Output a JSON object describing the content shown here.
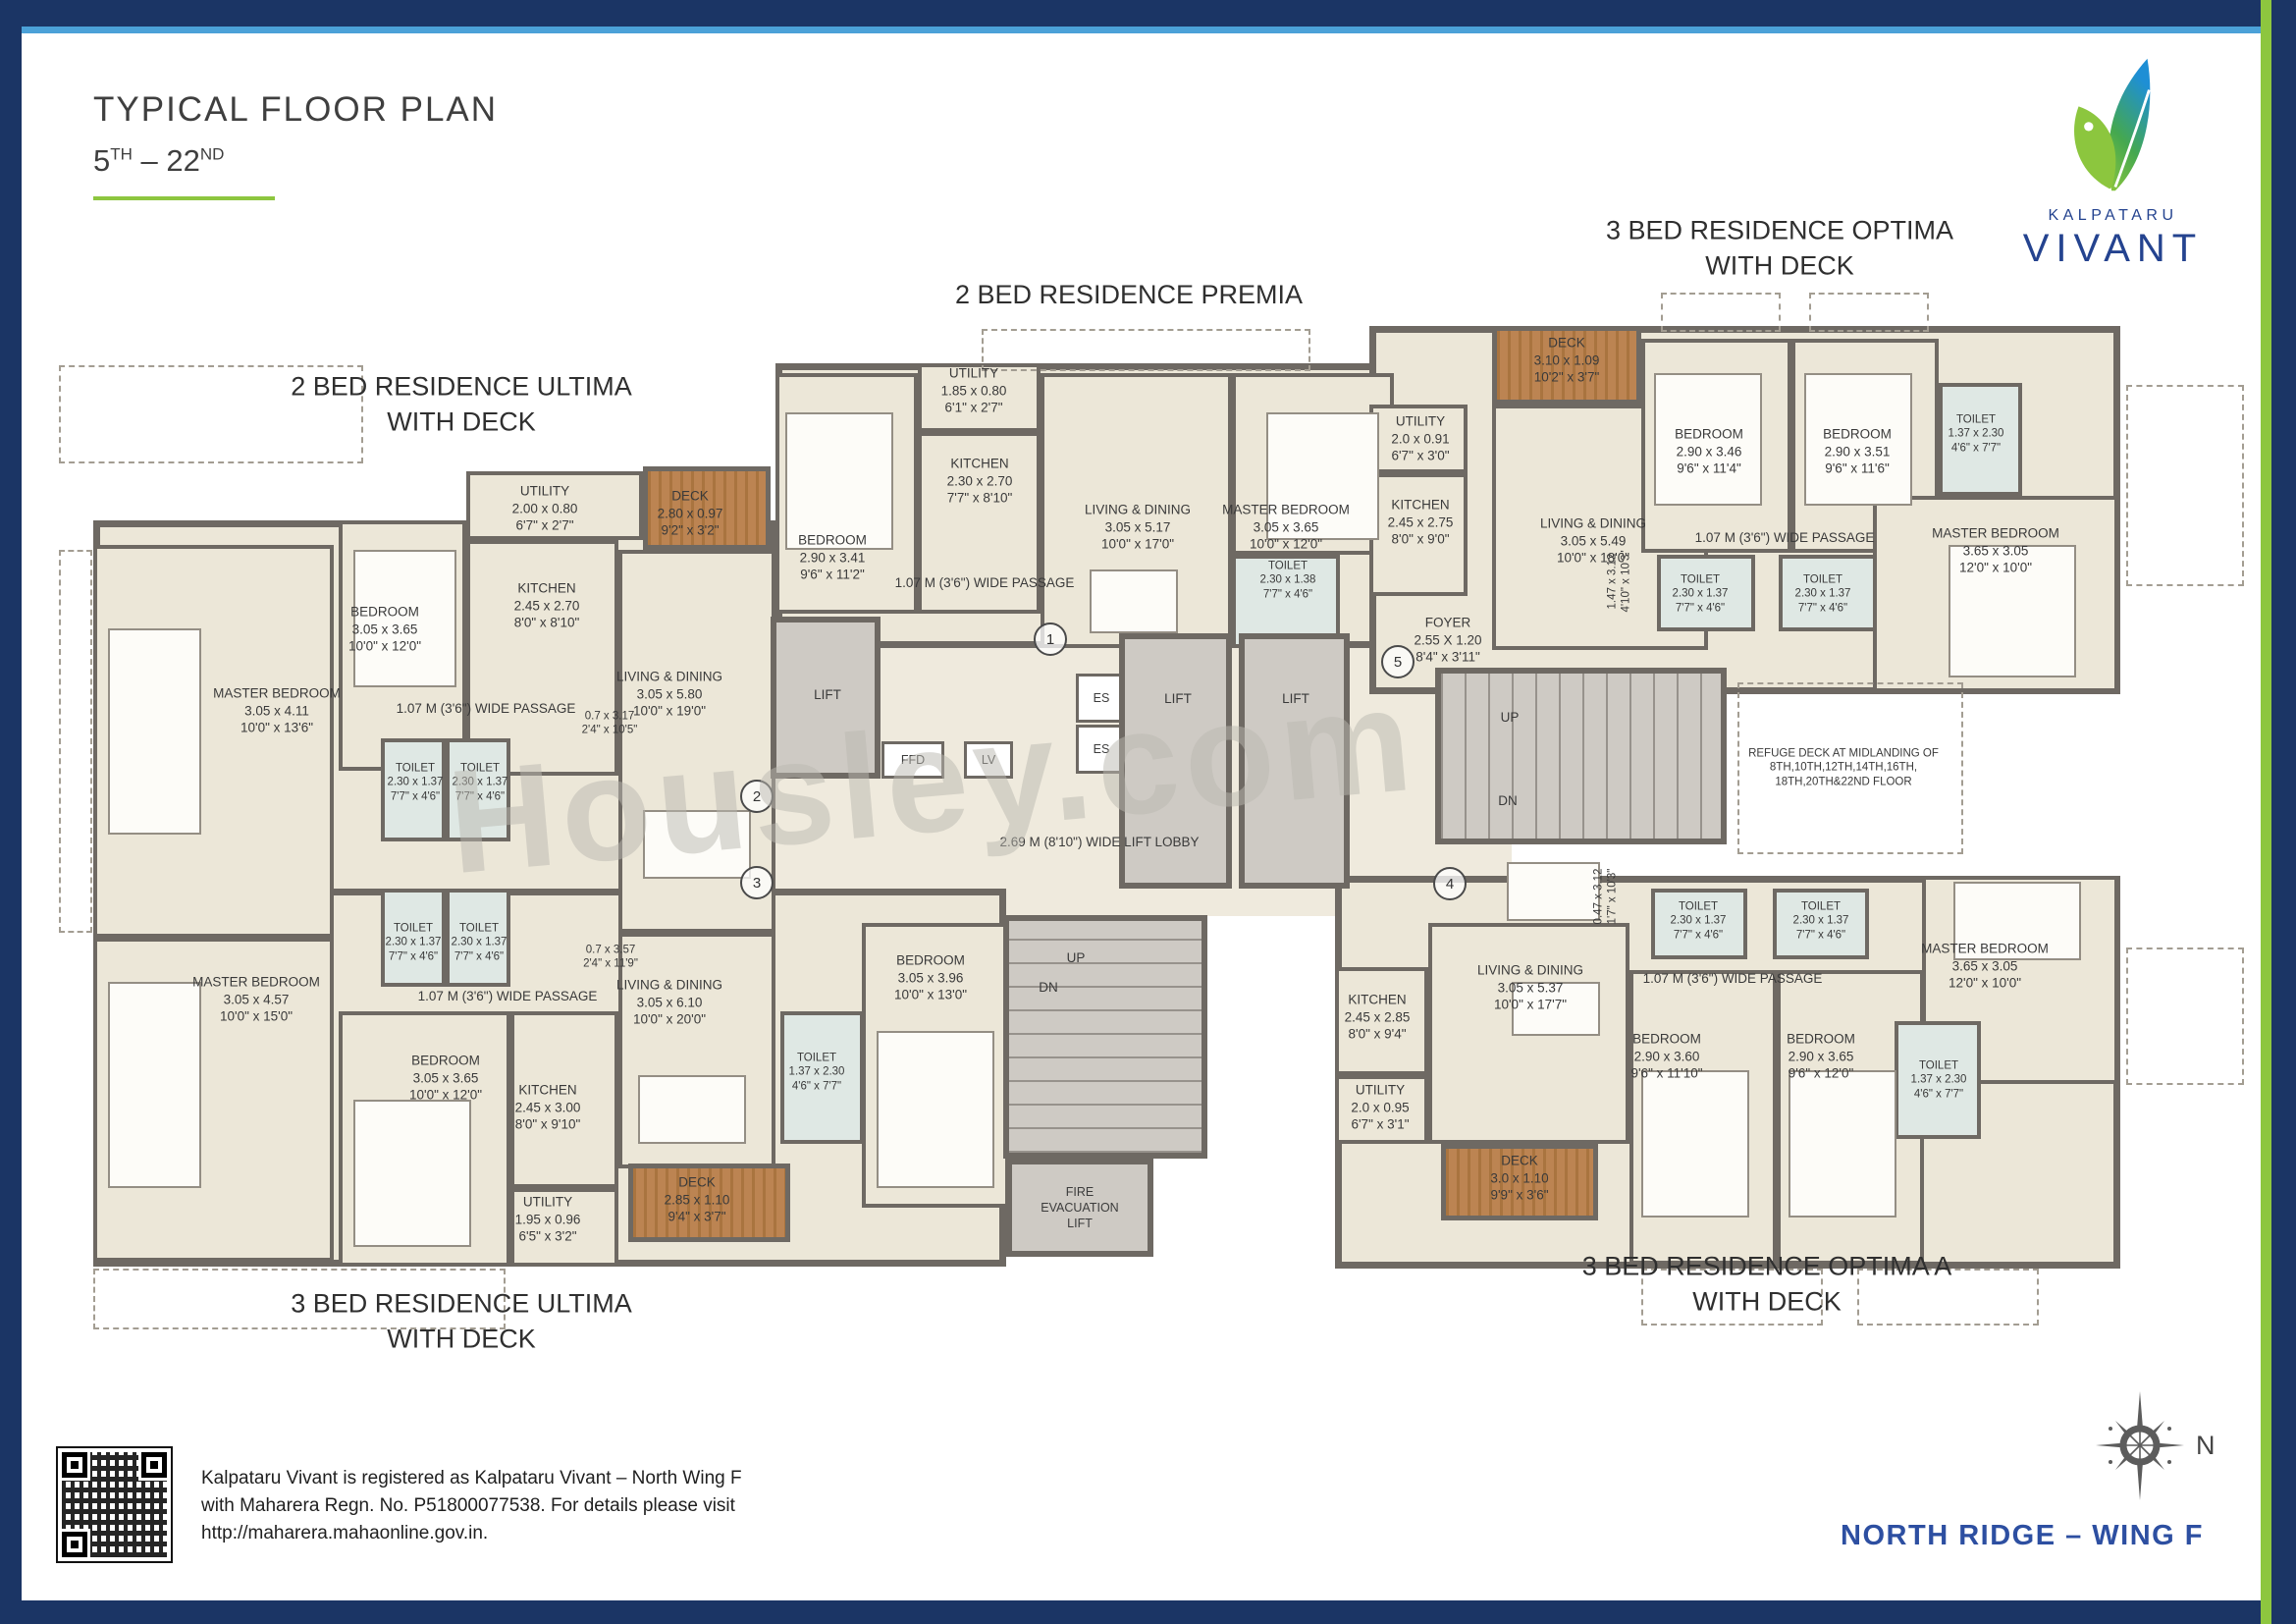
{
  "header": {
    "title": "TYPICAL FLOOR PLAN",
    "floors": {
      "from": "5",
      "from_sup": "TH",
      "sep": "–",
      "to": "22",
      "to_sup": "ND"
    }
  },
  "logo": {
    "brand": "KALPATARU",
    "name": "VIVANT"
  },
  "watermark": "Housley.com",
  "footer": {
    "line1": "Kalpataru Vivant is registered as  Kalpataru Vivant – North Wing F",
    "line2": "with Maharera Regn. No. P51800077538. For details please visit",
    "line3": "http://maharera.mahaonline.gov.in.",
    "wing": "NORTH RIDGE – WING F",
    "compass_n": "N"
  },
  "colors": {
    "border_navy": "#1b3565",
    "accent_green": "#8dc63f",
    "accent_lightblue": "#4ba1d8",
    "brand_blue": "#24438f",
    "wing_blue": "#2d4fa1",
    "wall_gray": "#6e6963",
    "deck_brown": "#b07a45"
  },
  "plan": {
    "titles": {
      "u2a": "2 BED RESIDENCE ULTIMA",
      "u2b": "WITH DECK",
      "p2": "2 BED RESIDENCE PREMIA",
      "o3a": "3 BED RESIDENCE OPTIMA",
      "o3b": "WITH DECK",
      "u3a": "3 BED RESIDENCE ULTIMA",
      "u3b": "WITH DECK",
      "a3a": "3 BED RESIDENCE OPTIMA A",
      "a3b": "WITH DECK"
    },
    "rooms": {
      "u2_utility": {
        "n": "UTILITY",
        "m": "2.00 x 0.80",
        "f": "6'7\" x 2'7\""
      },
      "u2_kitchen": {
        "n": "KITCHEN",
        "m": "2.45 x 2.70",
        "f": "8'0\" x 8'10\""
      },
      "u2_bedroom": {
        "n": "BEDROOM",
        "m": "3.05 x 3.65",
        "f": "10'0\" x 12'0\""
      },
      "u2_master": {
        "n": "MASTER BEDROOM",
        "m": "3.05 x 4.11",
        "f": "10'0\" x 13'6\""
      },
      "u2_deck": {
        "n": "DECK",
        "m": "2.80 x 0.97",
        "f": "9'2\" x 3'2\""
      },
      "u2_living": {
        "n": "LIVING & DINING",
        "m": "3.05 x 5.80",
        "f": "10'0\" x 19'0\""
      },
      "u2_toilet1": {
        "n": "TOILET",
        "m": "2.30 x 1.37",
        "f": "7'7\" x 4'6\""
      },
      "u2_toilet2": {
        "n": "TOILET",
        "m": "2.30 x 1.37",
        "f": "7'7\" x 4'6\""
      },
      "u2_ledge": {
        "m": "0.7 x 3.17",
        "f": "2'4\" x 10'5\""
      },
      "u3_master": {
        "n": "MASTER BEDROOM",
        "m": "3.05 x 4.57",
        "f": "10'0\" x 15'0\""
      },
      "u3_toilet1": {
        "n": "TOILET",
        "m": "2.30 x 1.37",
        "f": "7'7\" x 4'6\""
      },
      "u3_toilet2": {
        "n": "TOILET",
        "m": "2.30 x 1.37",
        "f": "7'7\" x 4'6\""
      },
      "u3_bedroom": {
        "n": "BEDROOM",
        "m": "3.05 x 3.65",
        "f": "10'0\" x 12'0\""
      },
      "u3_kitchen": {
        "n": "KITCHEN",
        "m": "2.45 x 3.00",
        "f": "8'0\" x 9'10\""
      },
      "u3_utility": {
        "n": "UTILITY",
        "m": "1.95 x 0.96",
        "f": "6'5\" x 3'2\""
      },
      "u3_living": {
        "n": "LIVING & DINING",
        "m": "3.05 x 6.10",
        "f": "10'0\" x 20'0\""
      },
      "u3_deck": {
        "n": "DECK",
        "m": "2.85 x 1.10",
        "f": "9'4\" x 3'7\""
      },
      "u3_toilet3": {
        "n": "TOILET",
        "m": "1.37 x 2.30",
        "f": "4'6\" x 7'7\""
      },
      "u3_bedroom2": {
        "n": "BEDROOM",
        "m": "3.05 x 3.96",
        "f": "10'0\" x 13'0\""
      },
      "u3_ledge": {
        "m": "0.7 x 3.57",
        "f": "2'4\" x 11'9\""
      },
      "p2_utility": {
        "n": "UTILITY",
        "m": "1.85 x 0.80",
        "f": "6'1\" x 2'7\""
      },
      "p2_kitchen": {
        "n": "KITCHEN",
        "m": "2.30 x 2.70",
        "f": "7'7\" x 8'10\""
      },
      "p2_bedroom": {
        "n": "BEDROOM",
        "m": "2.90 x 3.41",
        "f": "9'6\" x 11'2\""
      },
      "p2_living": {
        "n": "LIVING & DINING",
        "m": "3.05 x 5.17",
        "f": "10'0\" x 17'0\""
      },
      "p2_master": {
        "n": "MASTER BEDROOM",
        "m": "3.05 x 3.65",
        "f": "10'0\" x 12'0\""
      },
      "p2_toilet": {
        "n": "TOILET",
        "m": "2.30 x 1.38",
        "f": "7'7\" x 4'6\""
      },
      "o3_deck": {
        "n": "DECK",
        "m": "3.10 x 1.09",
        "f": "10'2\" x 3'7\""
      },
      "o3_utility": {
        "n": "UTILITY",
        "m": "2.0 x 0.91",
        "f": "6'7\" x 3'0\""
      },
      "o3_kitchen": {
        "n": "KITCHEN",
        "m": "2.45 x 2.75",
        "f": "8'0\" x 9'0\""
      },
      "o3_foyer": {
        "n": "FOYER",
        "m": "2.55 X 1.20",
        "f": "8'4\" x 3'11\""
      },
      "o3_living": {
        "n": "LIVING & DINING",
        "m": "3.05 x 5.49",
        "f": "10'0\" x 18'0\""
      },
      "o3_bedroom1": {
        "n": "BEDROOM",
        "m": "2.90 x 3.46",
        "f": "9'6\" x 11'4\""
      },
      "o3_bedroom2": {
        "n": "BEDROOM",
        "m": "2.90 x 3.51",
        "f": "9'6\" x 11'6\""
      },
      "o3_toilet1": {
        "n": "TOILET",
        "m": "2.30 x 1.37",
        "f": "7'7\" x 4'6\""
      },
      "o3_toilet2": {
        "n": "TOILET",
        "m": "2.30 x 1.37",
        "f": "7'7\" x 4'6\""
      },
      "o3_toilet3": {
        "n": "TOILET",
        "m": "1.37 x 2.30",
        "f": "4'6\" x 7'7\""
      },
      "o3_master": {
        "n": "MASTER BEDROOM",
        "m": "3.65 x 3.05",
        "f": "12'0\" x 10'0\""
      },
      "o3_shaft": {
        "m": "1.47 x 3.12",
        "f": "4'10\" x 10'3\""
      },
      "a3_kitchen": {
        "n": "KITCHEN",
        "m": "2.45 x 2.85",
        "f": "8'0\" x 9'4\""
      },
      "a3_utility": {
        "n": "UTILITY",
        "m": "2.0 x 0.95",
        "f": "6'7\" x 3'1\""
      },
      "a3_living": {
        "n": "LIVING & DINING",
        "m": "3.05 x 5.37",
        "f": "10'0\" x 17'7\""
      },
      "a3_deck": {
        "n": "DECK",
        "m": "3.0 x 1.10",
        "f": "9'9\" x 3'6\""
      },
      "a3_bedroom1": {
        "n": "BEDROOM",
        "m": "2.90 x 3.60",
        "f": "9'6\" x 11'10\""
      },
      "a3_bedroom2": {
        "n": "BEDROOM",
        "m": "2.90 x 3.65",
        "f": "9'6\" x 12'0\""
      },
      "a3_master": {
        "n": "MASTER BEDROOM",
        "m": "3.65 x 3.05",
        "f": "12'0\" x 10'0\""
      },
      "a3_toilet1": {
        "n": "TOILET",
        "m": "2.30 x 1.37",
        "f": "7'7\" x 4'6\""
      },
      "a3_toilet2": {
        "n": "TOILET",
        "m": "2.30 x 1.37",
        "f": "7'7\" x 4'6\""
      },
      "a3_toilet3": {
        "n": "TOILET",
        "m": "1.37 x 2.30",
        "f": "4'6\" x 7'7\""
      },
      "a3_shaft": {
        "m": "0.47 x 3.12",
        "f": "1'7\" x 10'3\""
      }
    },
    "labels": {
      "passage": "1.07 M (3'6\") WIDE PASSAGE",
      "lobby": "2.69 M (8'10\") WIDE LIFT LOBBY",
      "lift": "LIFT",
      "up": "UP",
      "dn": "DN",
      "ffd": "FFD",
      "lv": "LV",
      "es": "ES",
      "fire1": "FIRE",
      "fire2": "EVACUATION",
      "fire3": "LIFT",
      "refuge1": "REFUGE DECK AT MIDLANDING OF",
      "refuge2": "8TH,10TH,12TH,14TH,16TH,",
      "refuge3": "18TH,20TH&22ND FLOOR"
    },
    "markers": {
      "m1": "1",
      "m2": "2",
      "m3": "3",
      "m4": "4",
      "m5": "5"
    }
  }
}
